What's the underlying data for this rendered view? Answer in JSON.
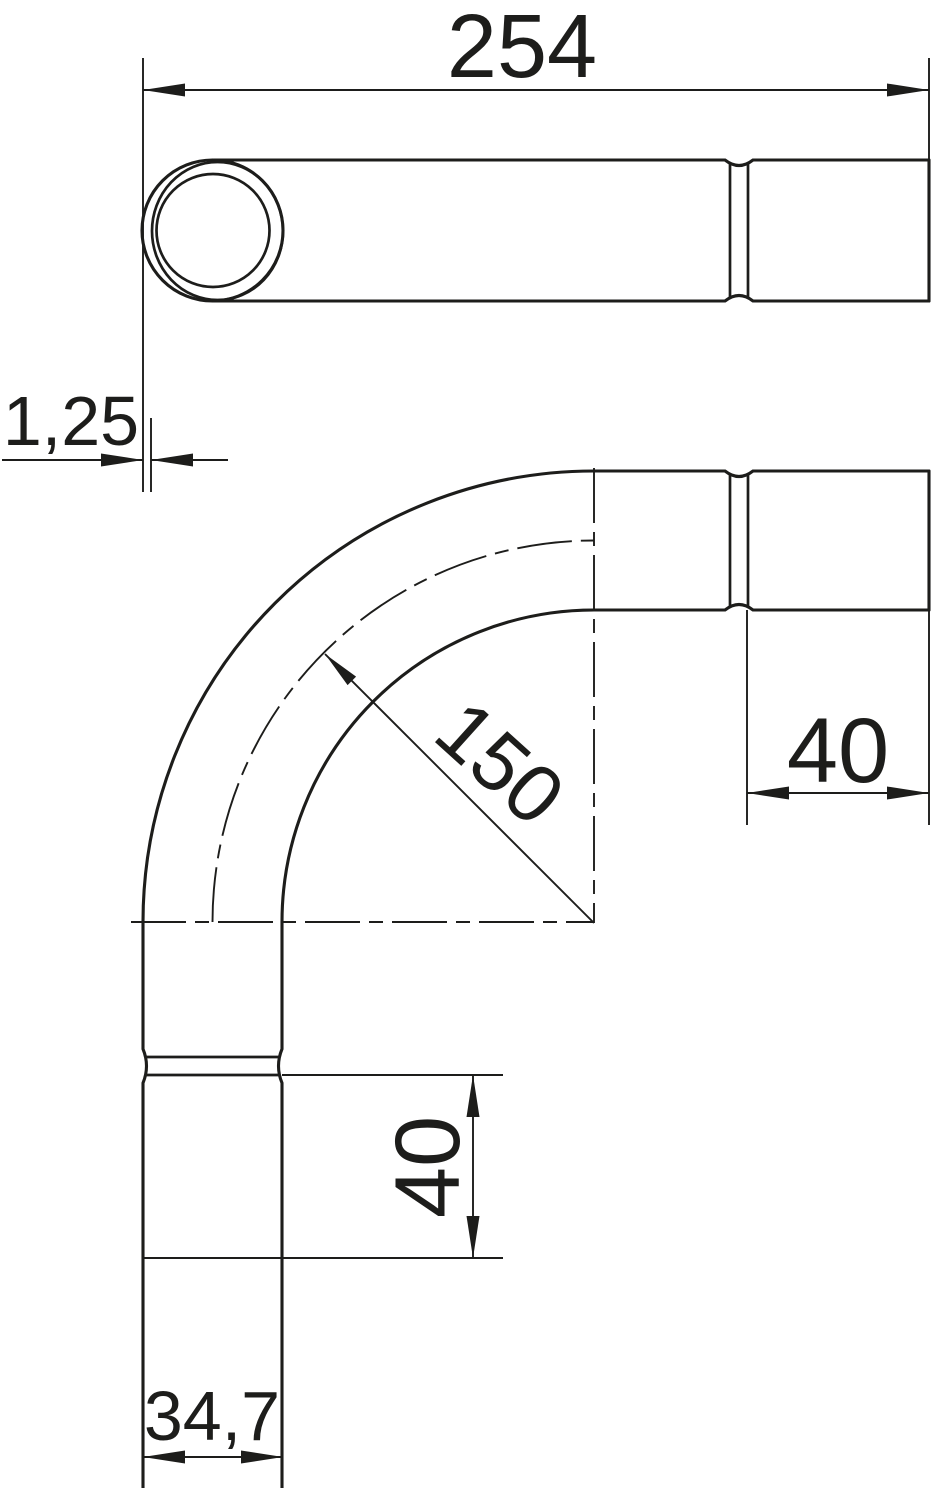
{
  "drawing": {
    "title": "pipe-bend-technical-drawing",
    "background": "#ffffff",
    "line_color": "#1d1d1b",
    "views": {
      "top_view": "straight pipe with end face and socket",
      "front_view": "90 degree pipe bend with sockets"
    },
    "dimensions": {
      "overall_length": {
        "value": "254",
        "meaning": "overall length"
      },
      "wall_thickness": {
        "value": "1,25",
        "meaning": "wall thickness"
      },
      "bend_radius": {
        "value": "150",
        "meaning": "bend radius"
      },
      "socket_length_right": {
        "value": "40",
        "meaning": "socket length horizontal leg"
      },
      "socket_length_bottom": {
        "value": "40",
        "meaning": "socket length vertical leg"
      },
      "outer_diameter": {
        "value": "34,7",
        "meaning": "pipe outer diameter"
      }
    }
  }
}
